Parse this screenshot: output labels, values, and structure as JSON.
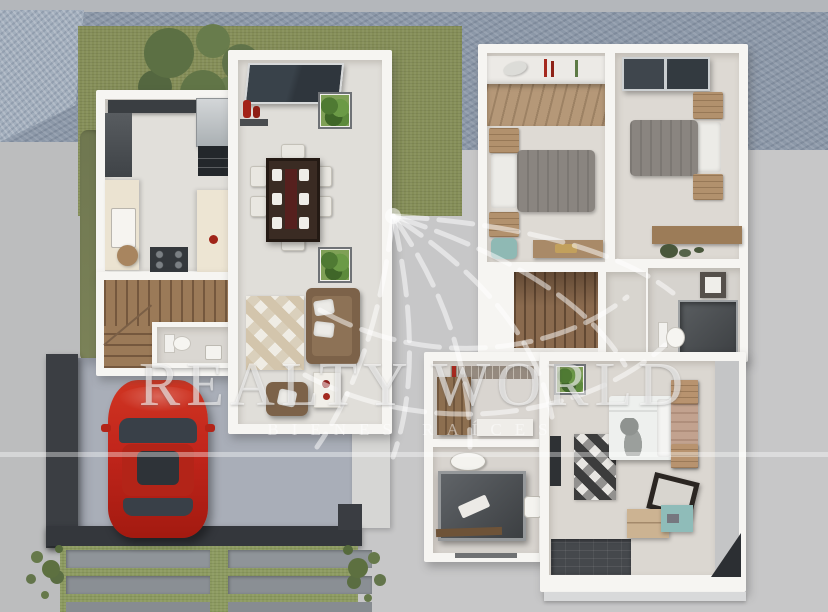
{
  "watermark": {
    "brand": "REALTY WORLD",
    "subtitle": "BIENES RAÍCES"
  },
  "palette": {
    "background": "#c7c7c8",
    "street": "#8c98a8",
    "grass": "#858e58",
    "wall_white": "#f6f5f2",
    "wood": "#9b7a58",
    "car_red": "#c1251b",
    "garage_dark": "#3c4046",
    "bed_gray": "#8a8580",
    "accent_teal": "#8fbcb9",
    "watermark_white": "rgba(255,255,255,0.55)"
  },
  "scene": {
    "description": "3D rendered top-down floor plan of a two-story house, real-estate listing image",
    "ground_floor_rooms": [
      "kitchen",
      "dining-room",
      "living-room",
      "half-bathroom",
      "stairs",
      "garage",
      "driveway",
      "front-yard"
    ],
    "upper_floor_rooms": [
      "bedroom-1",
      "bedroom-2",
      "shared-bathroom",
      "hallway",
      "stairs",
      "walk-in-closet",
      "master-bathroom",
      "master-bedroom"
    ],
    "objects": [
      "red-car",
      "dining-table-with-chairs",
      "sofa-set",
      "kitchen-counters",
      "refrigerator",
      "stove",
      "beds",
      "desks",
      "showers",
      "toilets",
      "rugs",
      "plants",
      "tree",
      "lawn",
      "street",
      "driveway-pavers"
    ]
  }
}
